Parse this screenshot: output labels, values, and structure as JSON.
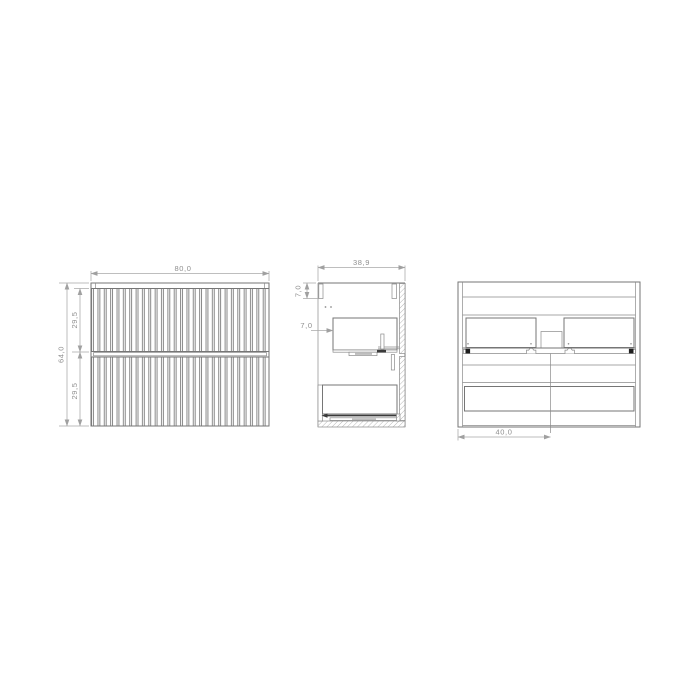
{
  "drawing": {
    "description": "technical-drawing-two-drawer-fluted-vanity-cabinet",
    "background": "#ffffff",
    "colors": {
      "main_line": "#767676",
      "thin_line": "#8a8a8a",
      "dimension_line": "#a8a8a8",
      "dimension_text": "#8f8f8f",
      "dark_detail": "#3a3a3a",
      "bracket_black": "#1f1f1f"
    },
    "views": {
      "front": {
        "name": "front-view",
        "width": "80,0",
        "height": "64,0",
        "upper_drawer_height": "29,5",
        "lower_drawer_height": "29,5"
      },
      "side": {
        "name": "side-section-view",
        "top_rail_height": "7,0",
        "depth": "38,9",
        "front_offset": "7,0"
      },
      "rear": {
        "name": "rear-view",
        "center_offset": "40,0"
      }
    }
  }
}
